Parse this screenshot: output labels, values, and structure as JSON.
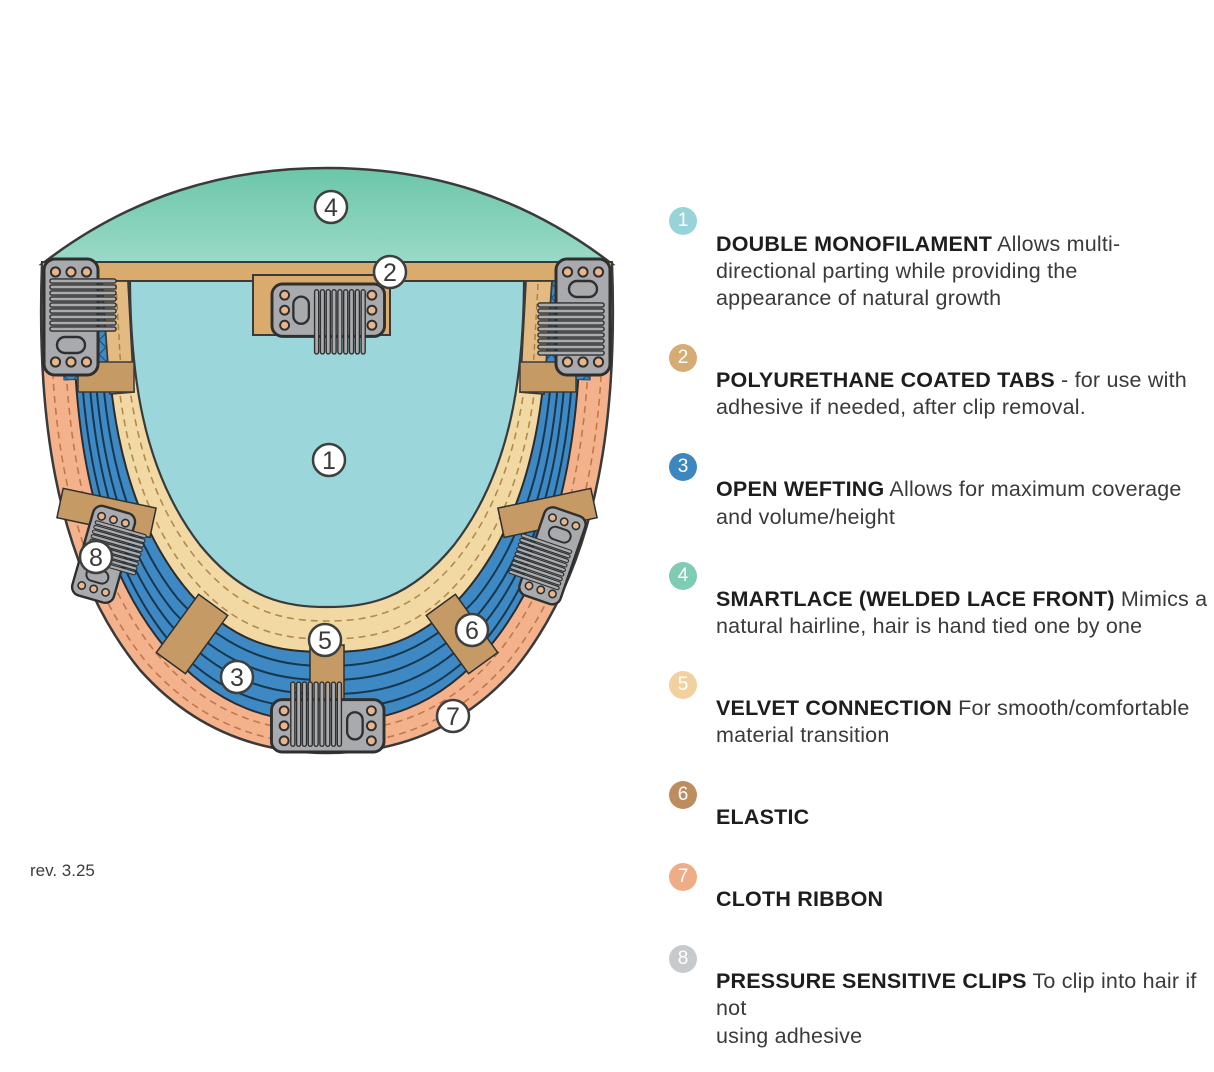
{
  "page": {
    "revision": "rev. 3.25",
    "background": "#ffffff"
  },
  "diagram": {
    "name": "wig cap construction diagram",
    "callouts": [
      "1",
      "2",
      "3",
      "4",
      "5",
      "6",
      "7",
      "8"
    ]
  },
  "colors": {
    "lace_top": "#6cc6a9",
    "lace_bottom": "#9adac8",
    "monofilament": "#9bd7da",
    "ribbon": "#f3b28c",
    "ribbon_stitch": "#c0784a",
    "wefting": "#3e88c4",
    "wefting_line": "#16384f",
    "velvet": "#f2d9a4",
    "velvet_stitch": "#b08a4e",
    "tab_bar": "#d9ac6e",
    "tab_light": "#e3ba82",
    "elastic": "#c69a64",
    "clip_gray": "#a8aaad",
    "outline": "#3a3a3a"
  },
  "legend": {
    "items": [
      {
        "num": "1",
        "badge_color": "#99d3da",
        "title": "DOUBLE MONOFILAMENT",
        "rest": " Allows multi-\ndirectional parting while providing the\nappearance of natural growth"
      },
      {
        "num": "2",
        "badge_color": "#d6ac72",
        "title": "POLYURETHANE COATED TABS",
        "rest": " - for use with\nadhesive if needed, after clip removal."
      },
      {
        "num": "3",
        "badge_color": "#3b87be",
        "title": "OPEN WEFTING",
        "rest": " Allows for maximum coverage\nand volume/height"
      },
      {
        "num": "4",
        "badge_color": "#7fccb2",
        "title": "SMARTLACE (WELDED LACE FRONT)",
        "rest": " Mimics a\nnatural hairline, hair is hand tied one by one"
      },
      {
        "num": "5",
        "badge_color": "#f2d1a0",
        "title": "VELVET CONNECTION",
        "rest": " For smooth/comfortable\nmaterial transition"
      },
      {
        "num": "6",
        "badge_color": "#bd8d5f",
        "title": "ELASTIC",
        "rest": ""
      },
      {
        "num": "7",
        "badge_color": "#efad87",
        "title": "CLOTH RIBBON",
        "rest": ""
      },
      {
        "num": "8",
        "badge_color": "#c7cacd",
        "title": "PRESSURE SENSITIVE CLIPS",
        "rest": " To clip into hair if not\nusing adhesive"
      }
    ]
  }
}
